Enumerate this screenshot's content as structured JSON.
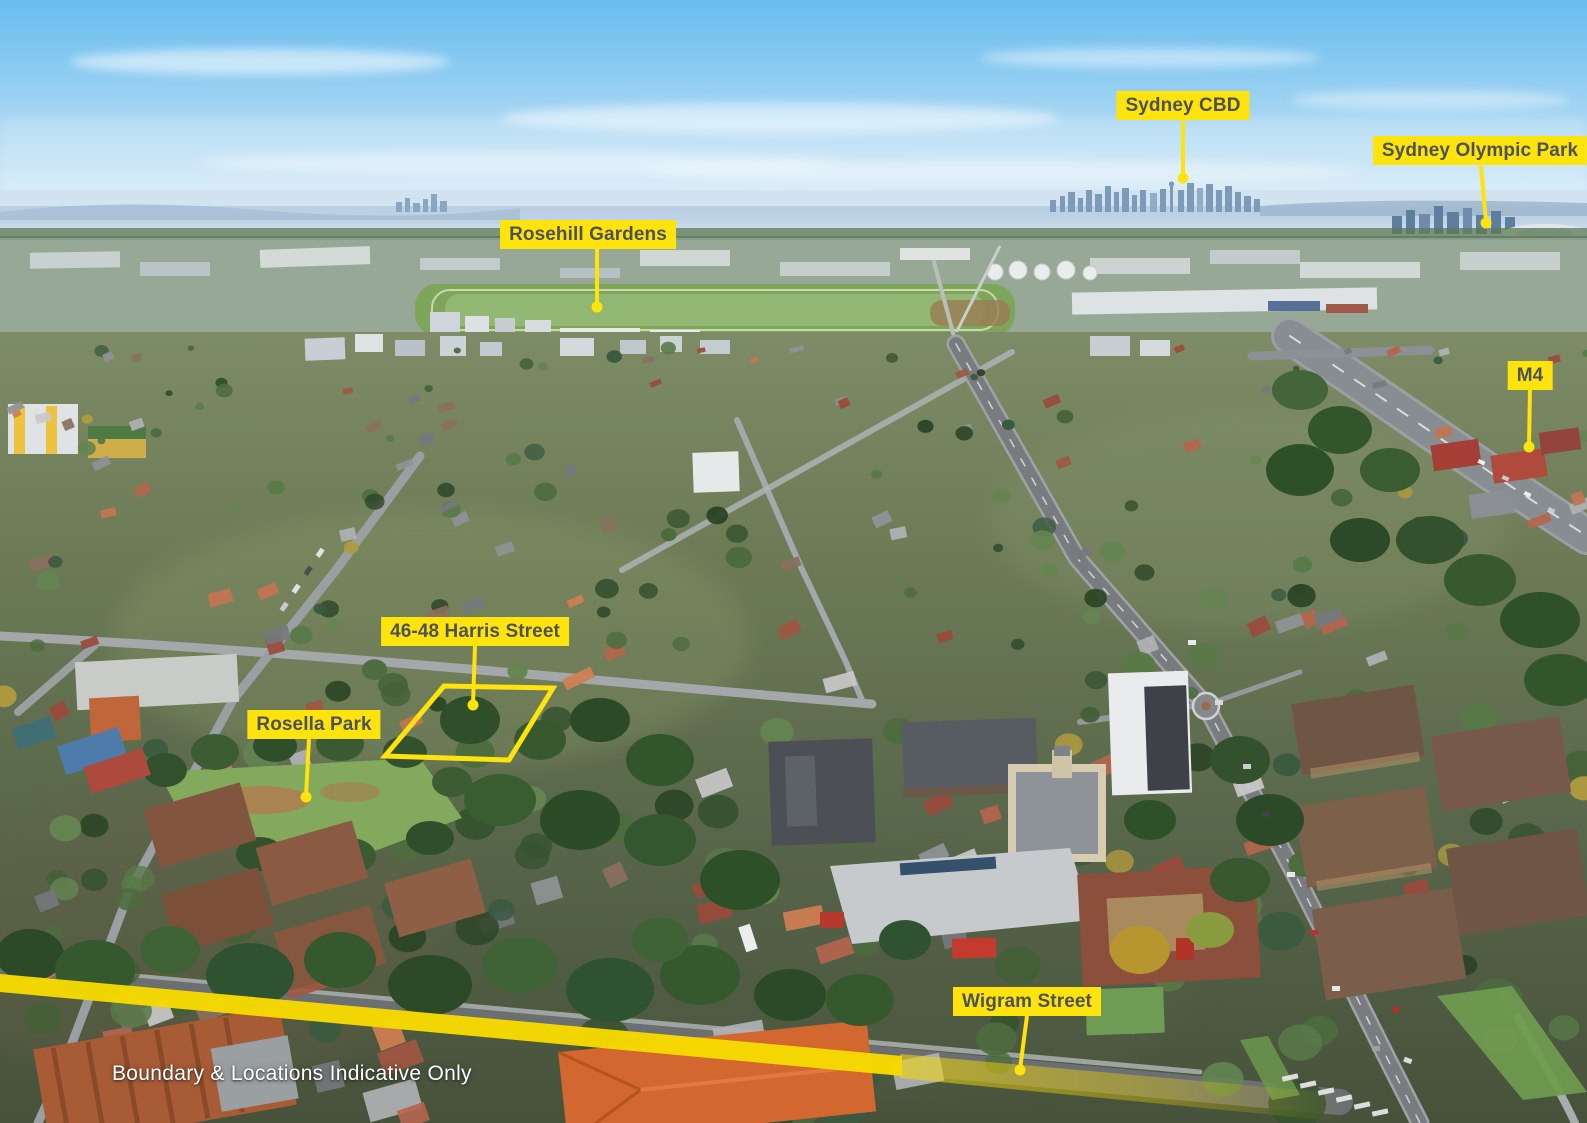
{
  "scene": {
    "type": "aerial-photograph",
    "description": "Aerial suburban view looking toward the city skyline, with yellow real-estate location markers"
  },
  "annotations": {
    "labels": [
      {
        "name": "sydney-cbd",
        "text": "Sydney CBD"
      },
      {
        "name": "sydney-olympic-park",
        "text": "Sydney Olympic Park"
      },
      {
        "name": "rosehill-gardens",
        "text": "Rosehill Gardens"
      },
      {
        "name": "m4",
        "text": "M4"
      },
      {
        "name": "harris-street-property",
        "text": "46-48 Harris Street"
      },
      {
        "name": "rosella-park",
        "text": "Rosella Park"
      },
      {
        "name": "wigram-street",
        "text": "Wigram Street"
      }
    ],
    "disclaimer": "Boundary & Locations Indicative Only",
    "colors": {
      "label_background": "#FFE30C",
      "label_text": "#4D525A",
      "marker_line": "#FFE30C",
      "street_highlight": "#F8DC00"
    }
  }
}
